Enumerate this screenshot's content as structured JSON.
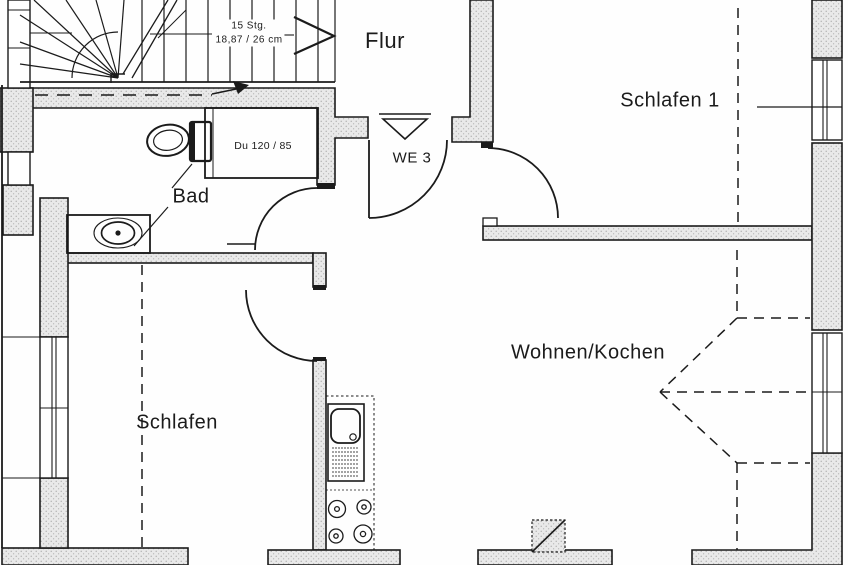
{
  "rooms": {
    "hall": "Flur",
    "bedroom1": "Schlafen 1",
    "bath": "Bad",
    "bedroom2": "Schlafen",
    "living_kitchen": "Wohnen/Kochen"
  },
  "annotations": {
    "unit": "WE 3",
    "shower": "Du 120 / 85",
    "stairs_steps": "15 Stg.",
    "stairs_dim": "18,87 / 26 cm"
  },
  "fixtures": [
    "staircase",
    "toilet",
    "shower-cabin",
    "washbasin",
    "kitchen-sink",
    "stove-4-burners",
    "chimney",
    "entrance-triangle-marker"
  ],
  "colors": {
    "line": "#1b1b1b",
    "wall_fill": "#e9e9e9",
    "background": "#fefefe"
  }
}
